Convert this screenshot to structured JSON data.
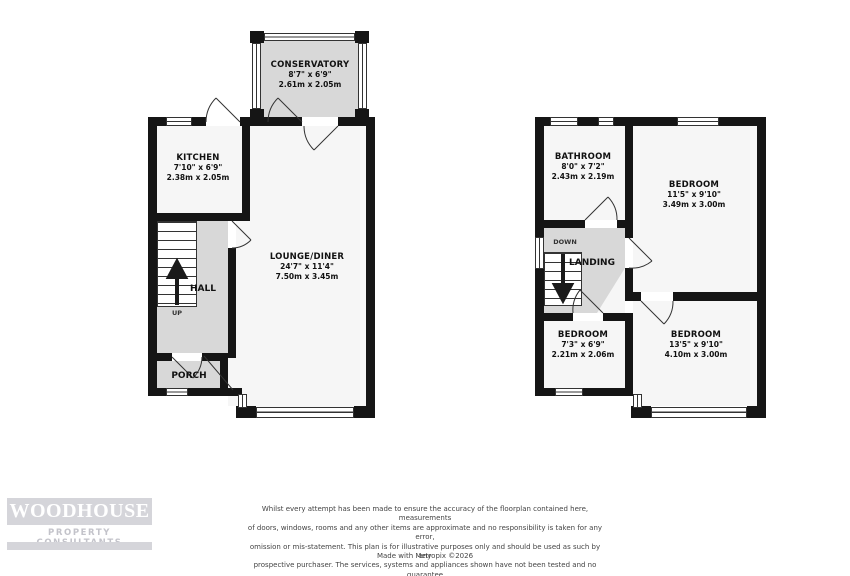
{
  "ground_floor": {
    "rooms": [
      {
        "name": "CONSERVATORY",
        "imperial": "8'7\" x 6'9\"",
        "metric": "2.61m x 2.05m"
      },
      {
        "name": "KITCHEN",
        "imperial": "7'10\" x 6'9\"",
        "metric": "2.38m x 2.05m"
      },
      {
        "name": "LOUNGE/DINER",
        "imperial": "24'7\" x 11'4\"",
        "metric": "7.50m x 3.45m"
      },
      {
        "name": "HALL"
      },
      {
        "name": "PORCH"
      }
    ],
    "stair_label": "UP"
  },
  "first_floor": {
    "rooms": [
      {
        "name": "BATHROOM",
        "imperial": "8'0\" x 7'2\"",
        "metric": "2.43m x 2.19m"
      },
      {
        "name": "BEDROOM",
        "imperial": "11'5\" x 9'10\"",
        "metric": "3.49m x 3.00m"
      },
      {
        "name": "BEDROOM",
        "imperial": "7'3\" x 6'9\"",
        "metric": "2.21m x 2.06m"
      },
      {
        "name": "BEDROOM",
        "imperial": "13'5\" x 9'10\"",
        "metric": "4.10m x 3.00m"
      },
      {
        "name": "LANDING"
      }
    ],
    "stair_label": "DOWN"
  },
  "logo": {
    "title": "WOODHOUSE",
    "subtitle": "PROPERTY CONSULTANTS"
  },
  "disclaimer": {
    "text": "Whilst every attempt has been made to ensure the accuracy of the floorplan contained here, measurements\nof doors, windows, rooms and any other items are approximate and no responsibility is taken for any error,\nomission or mis-statement. This plan is for illustrative purposes only and should be used as such by any\nprospective purchaser. The services, systems and appliances shown have not been tested and no guarantee\nas to their operability or efficiency can be given.",
    "credit": "Made with Metropix ©2026"
  },
  "colors": {
    "wall": "#151515",
    "room_fill": "#f6f6f6",
    "shaded_fill": "#d8d8d8",
    "logo_grey": "#d5d5da",
    "text": "#111111"
  }
}
